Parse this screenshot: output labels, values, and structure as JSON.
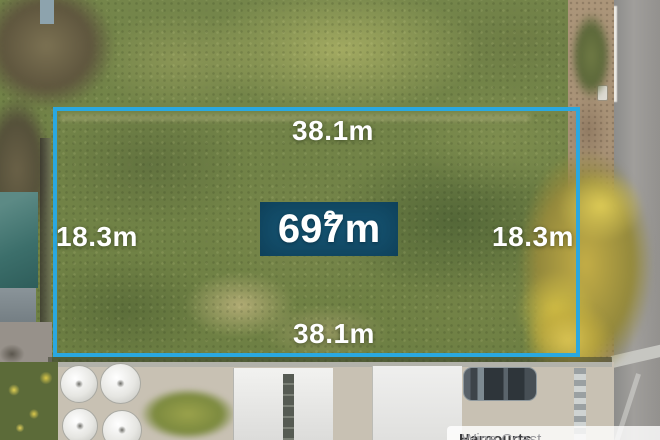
{
  "colors": {
    "boundary": "#2aa8e0",
    "badge_bg": "#14506d",
    "label_text": "#ffffff",
    "wm_brand": "#3b3b3d",
    "wm_suffix": "#97979b"
  },
  "dimensions": {
    "top": "38.1m",
    "bottom": "38.1m",
    "left": "18.3m",
    "right": "18.3m"
  },
  "area": {
    "value": "697m",
    "superscript": "2"
  },
  "watermark": {
    "brand": "Harcourts",
    "suffix": "Wine Coast"
  }
}
